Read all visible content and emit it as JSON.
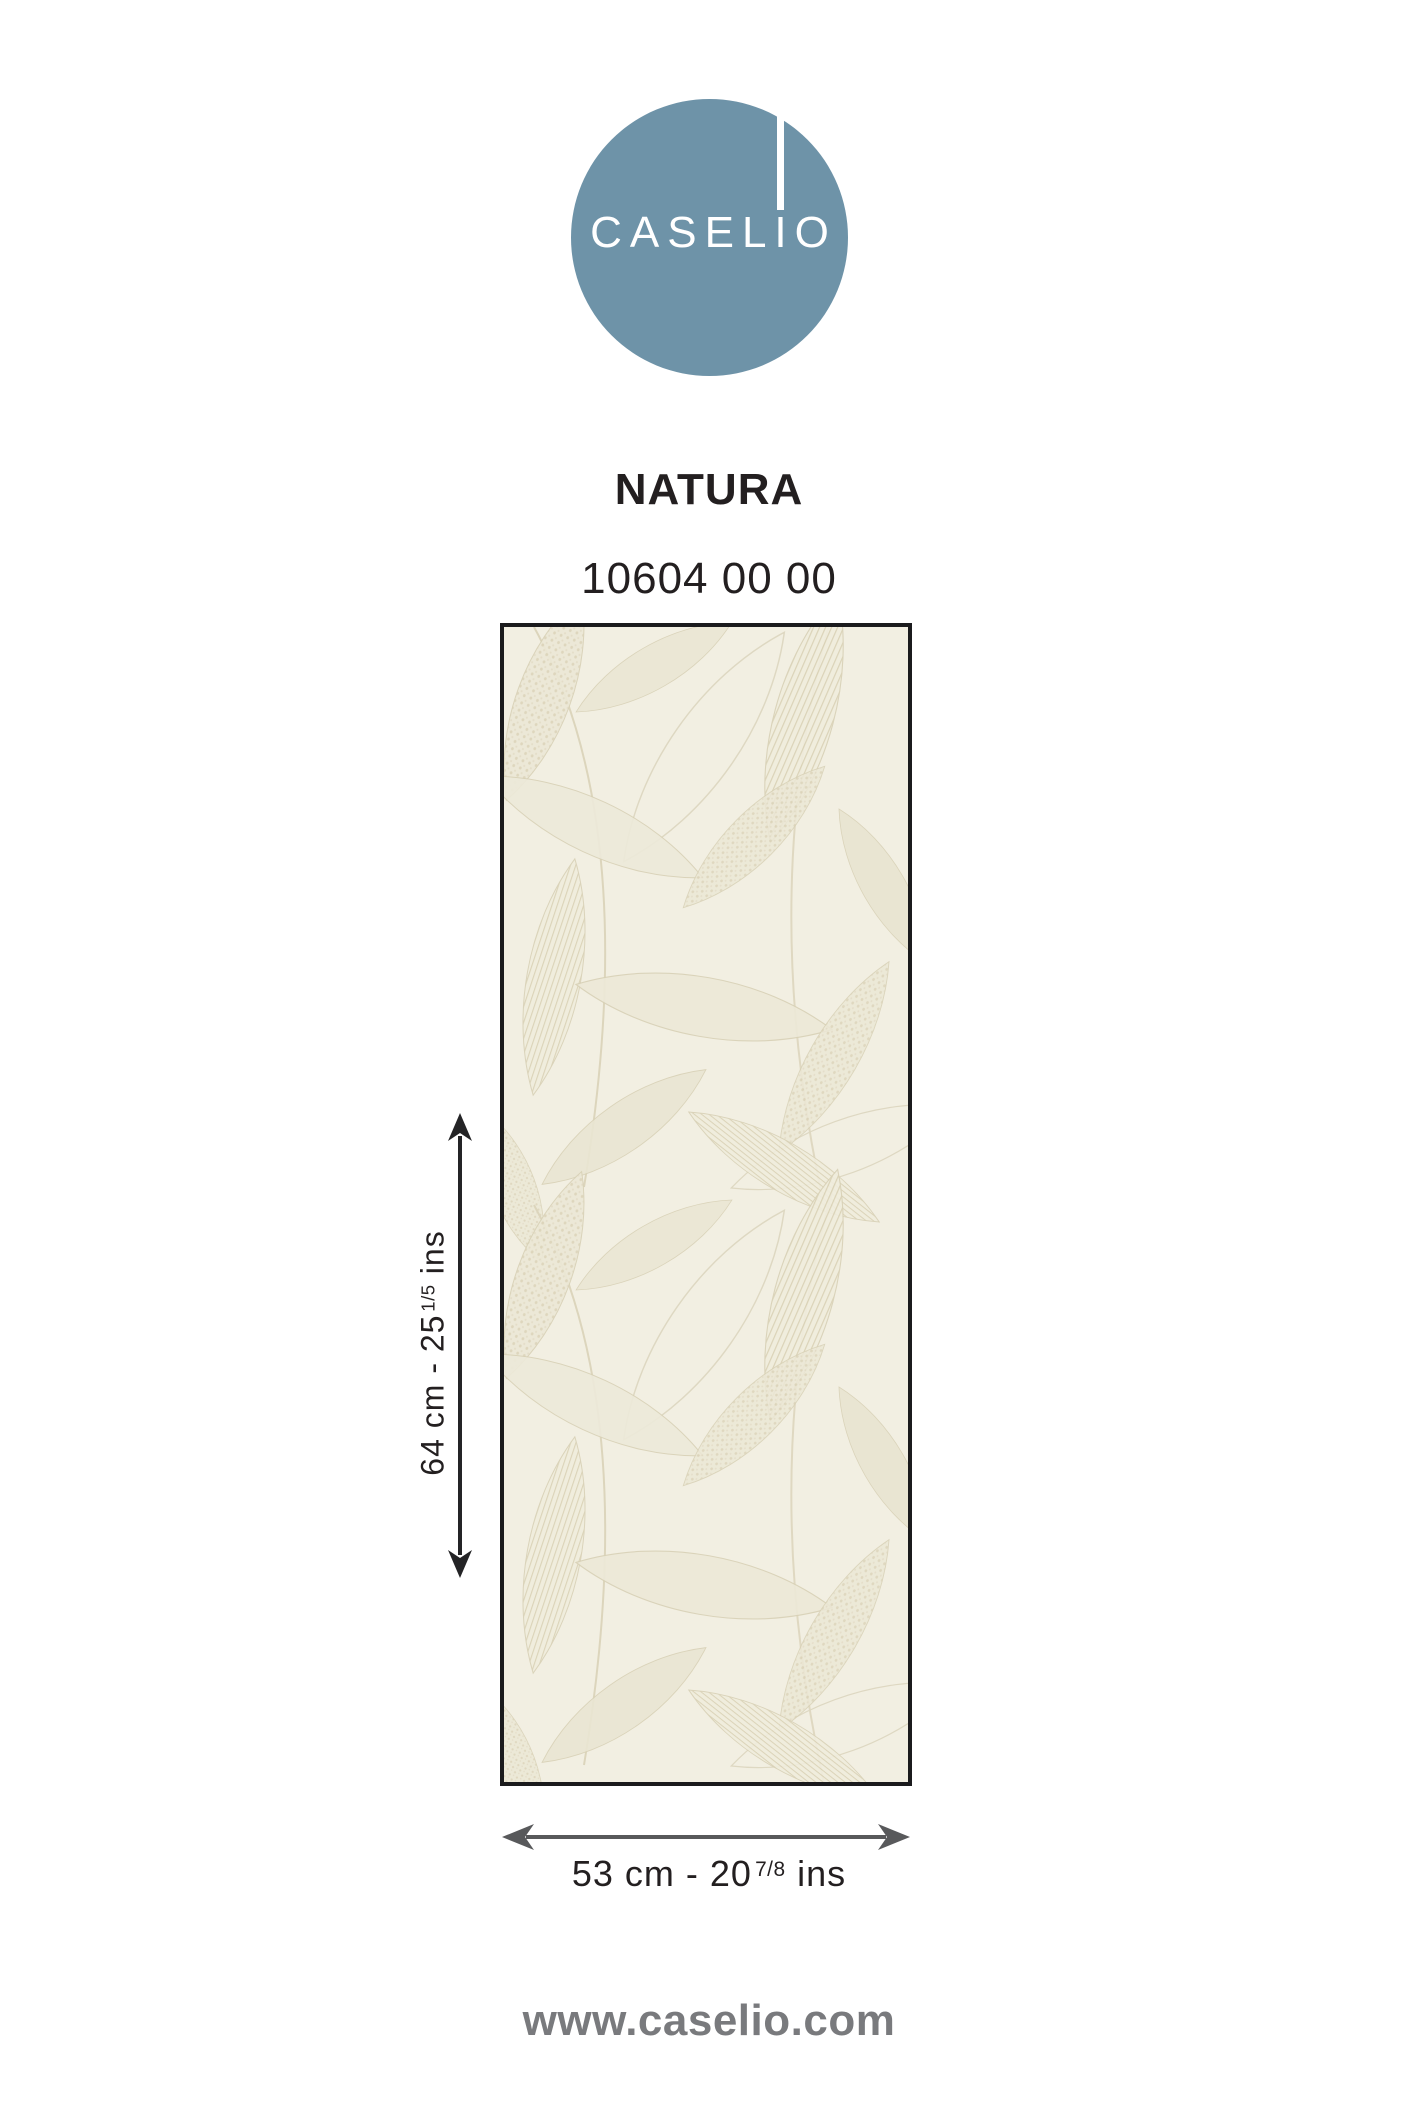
{
  "logo": {
    "text": "CASELIO",
    "background_color": "#6E93A8"
  },
  "product": {
    "collection_name": "NATURA",
    "reference": "10604 00 00"
  },
  "dimensions": {
    "height": {
      "value": "64 cm - 25",
      "fraction": "1/5",
      "unit": "ins"
    },
    "width": {
      "value": "53 cm - 20",
      "fraction": "7/8",
      "unit": "ins"
    }
  },
  "swatch": {
    "background_color": "#F2EFE2",
    "pattern": "leaf-motif"
  },
  "footer": {
    "website": "www.caselio.com"
  },
  "colors": {
    "text": "#231F20",
    "arrow_vertical": "#242426",
    "arrow_horizontal": "#58595B",
    "footer_text": "#797A7D"
  }
}
